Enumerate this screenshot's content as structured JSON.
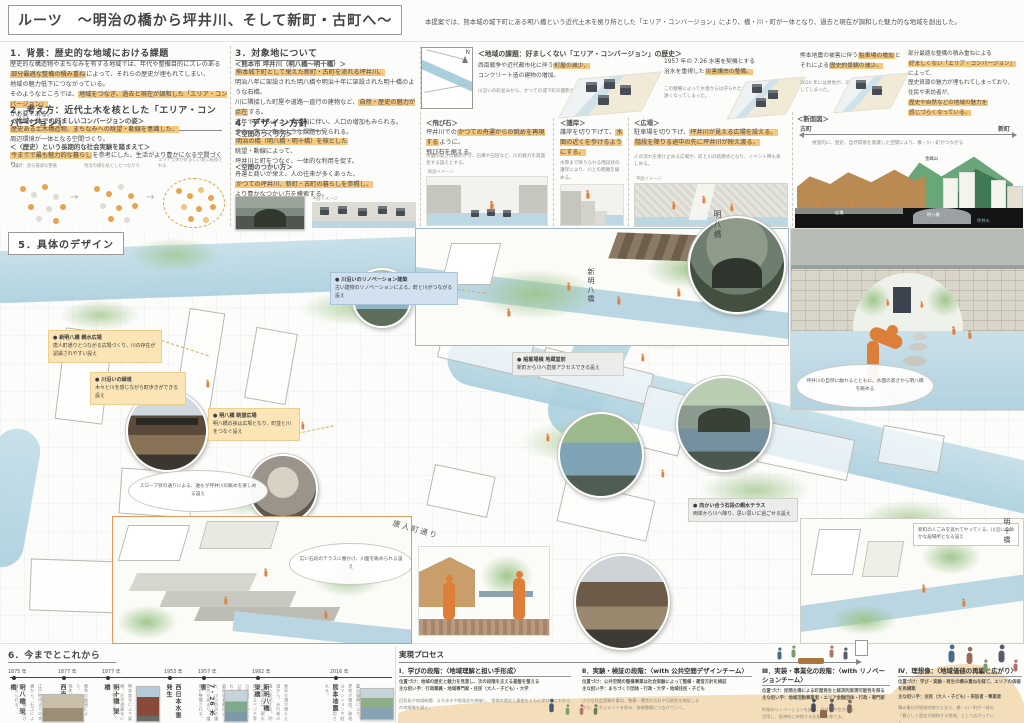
{
  "board": {
    "title": "ルーツ　～明治の橋から坪井川、そして新町・古町へ～",
    "lead": "本提案では、熊本城の城下町にある明八橋という近代土木を拠り所とした「エリア・コンバージョン」により、橋・川・町が一体となり、過去と現在が調和した魅力的な地域を創出した。"
  },
  "s1": {
    "heading": "1．背景：歴史的な地域における課題",
    "line1": "歴史的な構造物やまちなみを有する地域では、年代や整備目的にズレのある",
    "line2_hl": "部分最適な整備の積み重ね",
    "line2_rest": "によって、それらの歴史が埋もれてしまい、",
    "line3": "地域の魅力低下につながっている。",
    "line4_pre": "そのようなところでは、",
    "line4_hl": "地域をつなぎ、過去と現在が調和した「エリア・コンバージョン」",
    "line5": "が必要である。"
  },
  "s2": {
    "heading": "2．考え方：近代土木を核とした「エリア・コンバージョン」",
    "sub1": "＜地域一体での好ましいコンバージョンの姿＞",
    "sub1_hl": "歴史ある土木構造物、まちなみへの眺望・動線を意識した、",
    "sub1_rest": "周辺環境が一体となる空間づくり。",
    "sub2": "＜〈歴史〉という長期的な社会実験を踏まえて＞",
    "sub2_hl": "今までで最も魅力的な暮らし",
    "sub2_rest": "を参考にした、生活がより豊かになる空間づくり。",
    "cap1": "現状：部分最適な整備",
    "cap2": "明治の橋を核としたつながり",
    "cap3": "エリア全体が好ましい姿に転換される"
  },
  "s3": {
    "heading": "3．対象地について",
    "sub": "＜熊本市 坪井川（明八橋～明十橋）＞",
    "hl1": "熊本城下町として栄えた新町・古町を流れる坪井川。",
    "line2": "明治八年に架設された明八橋や明治十年に架設された明十橋のような石橋、",
    "line3_pre": "川に隣接した町屋や道路一直行の建物など、",
    "line3_hl": "自然・歴史の魅力が点在",
    "line3_post": "する。",
    "line4": "近年ではマンションの増加に伴い、人口の増加もみられる。",
    "line5": "その一方で、右のような課題も見られる。"
  },
  "s4": {
    "heading": "4．デザイン方針",
    "sub1": "＜空間のつくり方＞",
    "sub1_hl": "明治の橋（明八橋・明十橋）を核とした",
    "sub1_l2": "眺望・動線によって、",
    "sub1_l3": "坪井川と町をつなぐ、一体的な利用を促す。",
    "sub2": "＜空間のつかい方＞",
    "sub2_l1": "舟運と商いが栄え、人の往来が多くあった、",
    "sub2_hl": "かつての坪井川、新町・古町の暮らしを参照し、",
    "sub2_l3": "より豊かなつかい方を模索する。",
    "plan_label": "平面イメージ"
  },
  "issues": {
    "heading": "＜地域の課題：好ましくない「エリア・コンバージョン」の歴史＞",
    "i1_pre": "西南戦争や近代都市化に伴う",
    "i1_hl": "町屋の減少、",
    "i1_l2": "コンクリート造の建物の増加。",
    "i1_note": "川沿いの町並みから、かつての城下町の面影が失われていった。",
    "i2_l1": "1957 年の 7.26 水害を契機とする",
    "i2_l2_pre": "治水を重視した",
    "i2_l2_hl": "災害護岸の整備。",
    "i2_note": "この整備によって水害からは守られたが、人と川の距離は遠くなってしまった。",
    "i3_pre": "熊本地震の被害に伴う",
    "i3_hl": "駐車場の増加",
    "i3_mid": "と",
    "i3_l2_pre": "それによる",
    "i3_l2_hl": "歴史的景観の減少。",
    "i3_note": "2020 年には更地が、2017 年には駐車場が増加してしまった。"
  },
  "summary": {
    "l1": "部分最適な整備の積み重ねによる",
    "l2_hl": "好ましくない「エリア・コンバージョン」",
    "l3": "によって、",
    "l4": "歴史資源の魅力が埋もれてしまっており、",
    "l5": "住民や来訪者が、",
    "l6_hl": "歴史や自然などの地域の魅力を",
    "l7_hl": "感じづらくなっている。"
  },
  "policies": [
    {
      "title": "＜飛び石＞",
      "l1_pre": "坪井川での",
      "l1_hl": "かつての舟運からの眺めを再現する",
      "l1_post": "ように、",
      "l2": "飛び石を据える。",
      "note": "水面の高さの眺めから、石橋や石垣など、川の魅力を再発見する設えとする。",
      "img_label": "断面イメージ"
    },
    {
      "title": "＜護岸＞",
      "l1_pre": "護岸を切り下げて、",
      "l1_hl": "水面の近くを歩けるようにする。",
      "note": "水際まで降りられる階段状の護岸により、川との距離を縮める。",
      "img_label": "断面イメージ"
    },
    {
      "title": "＜広場＞",
      "l1_pre": "駐車場を切り下げ、",
      "l1_hl": "坪井川が見える広場を設える。",
      "l2_hl": "階段を降りる途中の先に坪井川が映え渡る。",
      "note": "人の流れを受け止める広場が、町と川の結節点となり、イベント時も楽しめる。",
      "img_label": "平面イメージ"
    },
    {
      "title": "＜断面図＞",
      "left_label": "古町",
      "right_label": "新町",
      "note": "視覚的に、歴史、自然環境を意識した空間により、橋・川・町がつながる",
      "mountain": "金峰山",
      "bridge": "明八橋",
      "river": "坪井川",
      "plaza": "広場"
    }
  ],
  "s5": {
    "heading": "5．具体のデザイン"
  },
  "map": {
    "bridge1": "新明八橋",
    "bridge2": "明八橋",
    "bridge3": "明十橋",
    "street": "唐人町通り",
    "compass": "N",
    "callouts": [
      {
        "title": "● 新明八橋 親水広場",
        "body": "唐人町通りとつながる広場づくり、川の存在が認識されやすい設え"
      },
      {
        "title": "● 川沿いの緑道",
        "body": "木々と川を感じながら町歩きができる設え"
      },
      {
        "title": "● 明八橋 眺望広場",
        "body": "明八橋の袂は広場となり、町並と川をつなぐ設え"
      },
      {
        "title": "● 川沿いのリノベーション建築",
        "body": "古い建物のリノベーションによる、町と川がつながる設え"
      },
      {
        "title": "● 船着場横 地蔵堂前",
        "body": "新町から川へ直接アクセスできる設え"
      },
      {
        "title": "● 向かい合う石段の親水テラス",
        "body": "両岸から川へ降り、思い思いに過ごせる設え"
      }
    ],
    "captions": {
      "persp": "坪井川の自然に触れるとともに、水面の高さから明八橋を眺める",
      "slope": "スロープ状の通りによる、誰もが坪井川の眺めを楽しめる設え",
      "terrace": "広い石段のテラスに腰かけ、川面を眺められる設え",
      "quiet": "新町の人ごみを逃れてやってくる、川沿いの静かな居場所となる設え"
    }
  },
  "timeline": {
    "heading": "6．今までとこれから",
    "items": [
      {
        "year": "1875 年",
        "event": "明八橋 架橋",
        "desc": "江戸時代までの木橋から、石工によって、石橋に架け替えられる。"
      },
      {
        "year": "1877 年",
        "event": "西南戦争",
        "desc": "戦争の被害により、町の大部分が焼失。"
      },
      {
        "year": "1877 年",
        "event": "明十橋 架橋",
        "desc": "熊本県令により架橋。近代道路化に伴い整備される。"
      },
      {
        "year": "1953 年",
        "event": "西日本水害 発生",
        "desc": ""
      },
      {
        "year": "1957 年",
        "event": "7・26 水害",
        "desc": "豪雨の多発により、川の防災の重要性が高まり、護岸が整備される。"
      },
      {
        "year": "1982 年",
        "event": "新明八橋 架橋",
        "desc": "車両交通が増えた道から、歩行者の道へ変化する。明八橋周辺は、親水性のあるベンチ等の設置によって、公園として整備される。"
      },
      {
        "year": "2016 年",
        "event": "熊本地震",
        "desc": "震災復興により、更地が増加。跡地はマンションや駐車場として利用される。"
      }
    ]
  },
  "process": {
    "heading": "実現プロセス",
    "stages": [
      {
        "title": "Ⅰ．学びの段階：〈地域理解と担い手形成〉",
        "pos": "位置づけ：地域の歴史と魅力を見直し、次の段階を支える基盤を整える",
        "actors": "主な担い手：行政職員・地域専門家・住民（大人・子ども）・大学",
        "body": "回覧板や地域新聞、まち歩きや勉強会を開催し、地域の歴史と資産をともに学び、これからの地域像を描く。"
      },
      {
        "title": "Ⅱ．実験・検証の段階：〈with 公共空間デザインチーム〉",
        "pos": "位置づけ：公共空間の整備事業は社会実験によって整備・運営方針を検証",
        "actors": "主な担い手：まちづくり団体・行政・大学・地域住民・子ども",
        "body": "小さな社会実験を重ね、整備・運営の方針や可能性を検証しながら、マネジメントを育み、本格整備につなげていく。"
      },
      {
        "title": "Ⅲ．実装・事業化の段階：〈with リノベーションチーム〉",
        "pos": "位置づけ：民間主導による町屋再生と経済的実現可能性を探る",
        "actors": "主な担い手：地域活動事業者・エリア金融団体・行政・専門家",
        "body": "町屋のリノベーションを進め、空き家や空き地を活用し、経済的に持続する仕組みを育てる。"
      },
      {
        "title": "Ⅳ．理想像：〈地域価値の再編と広がり〉",
        "pos": "位置づけ：学び・実験・再生の積み重ねを経て、エリアの価値を再構築",
        "actors": "主な担い手：住民（大人・子ども）・来訪者・事業者",
        "body": "積み重ねが地域の誇りとなり、橋・川・町が一体の「暮らしと歴史が調和する地域」として広がっていく。"
      }
    ]
  }
}
